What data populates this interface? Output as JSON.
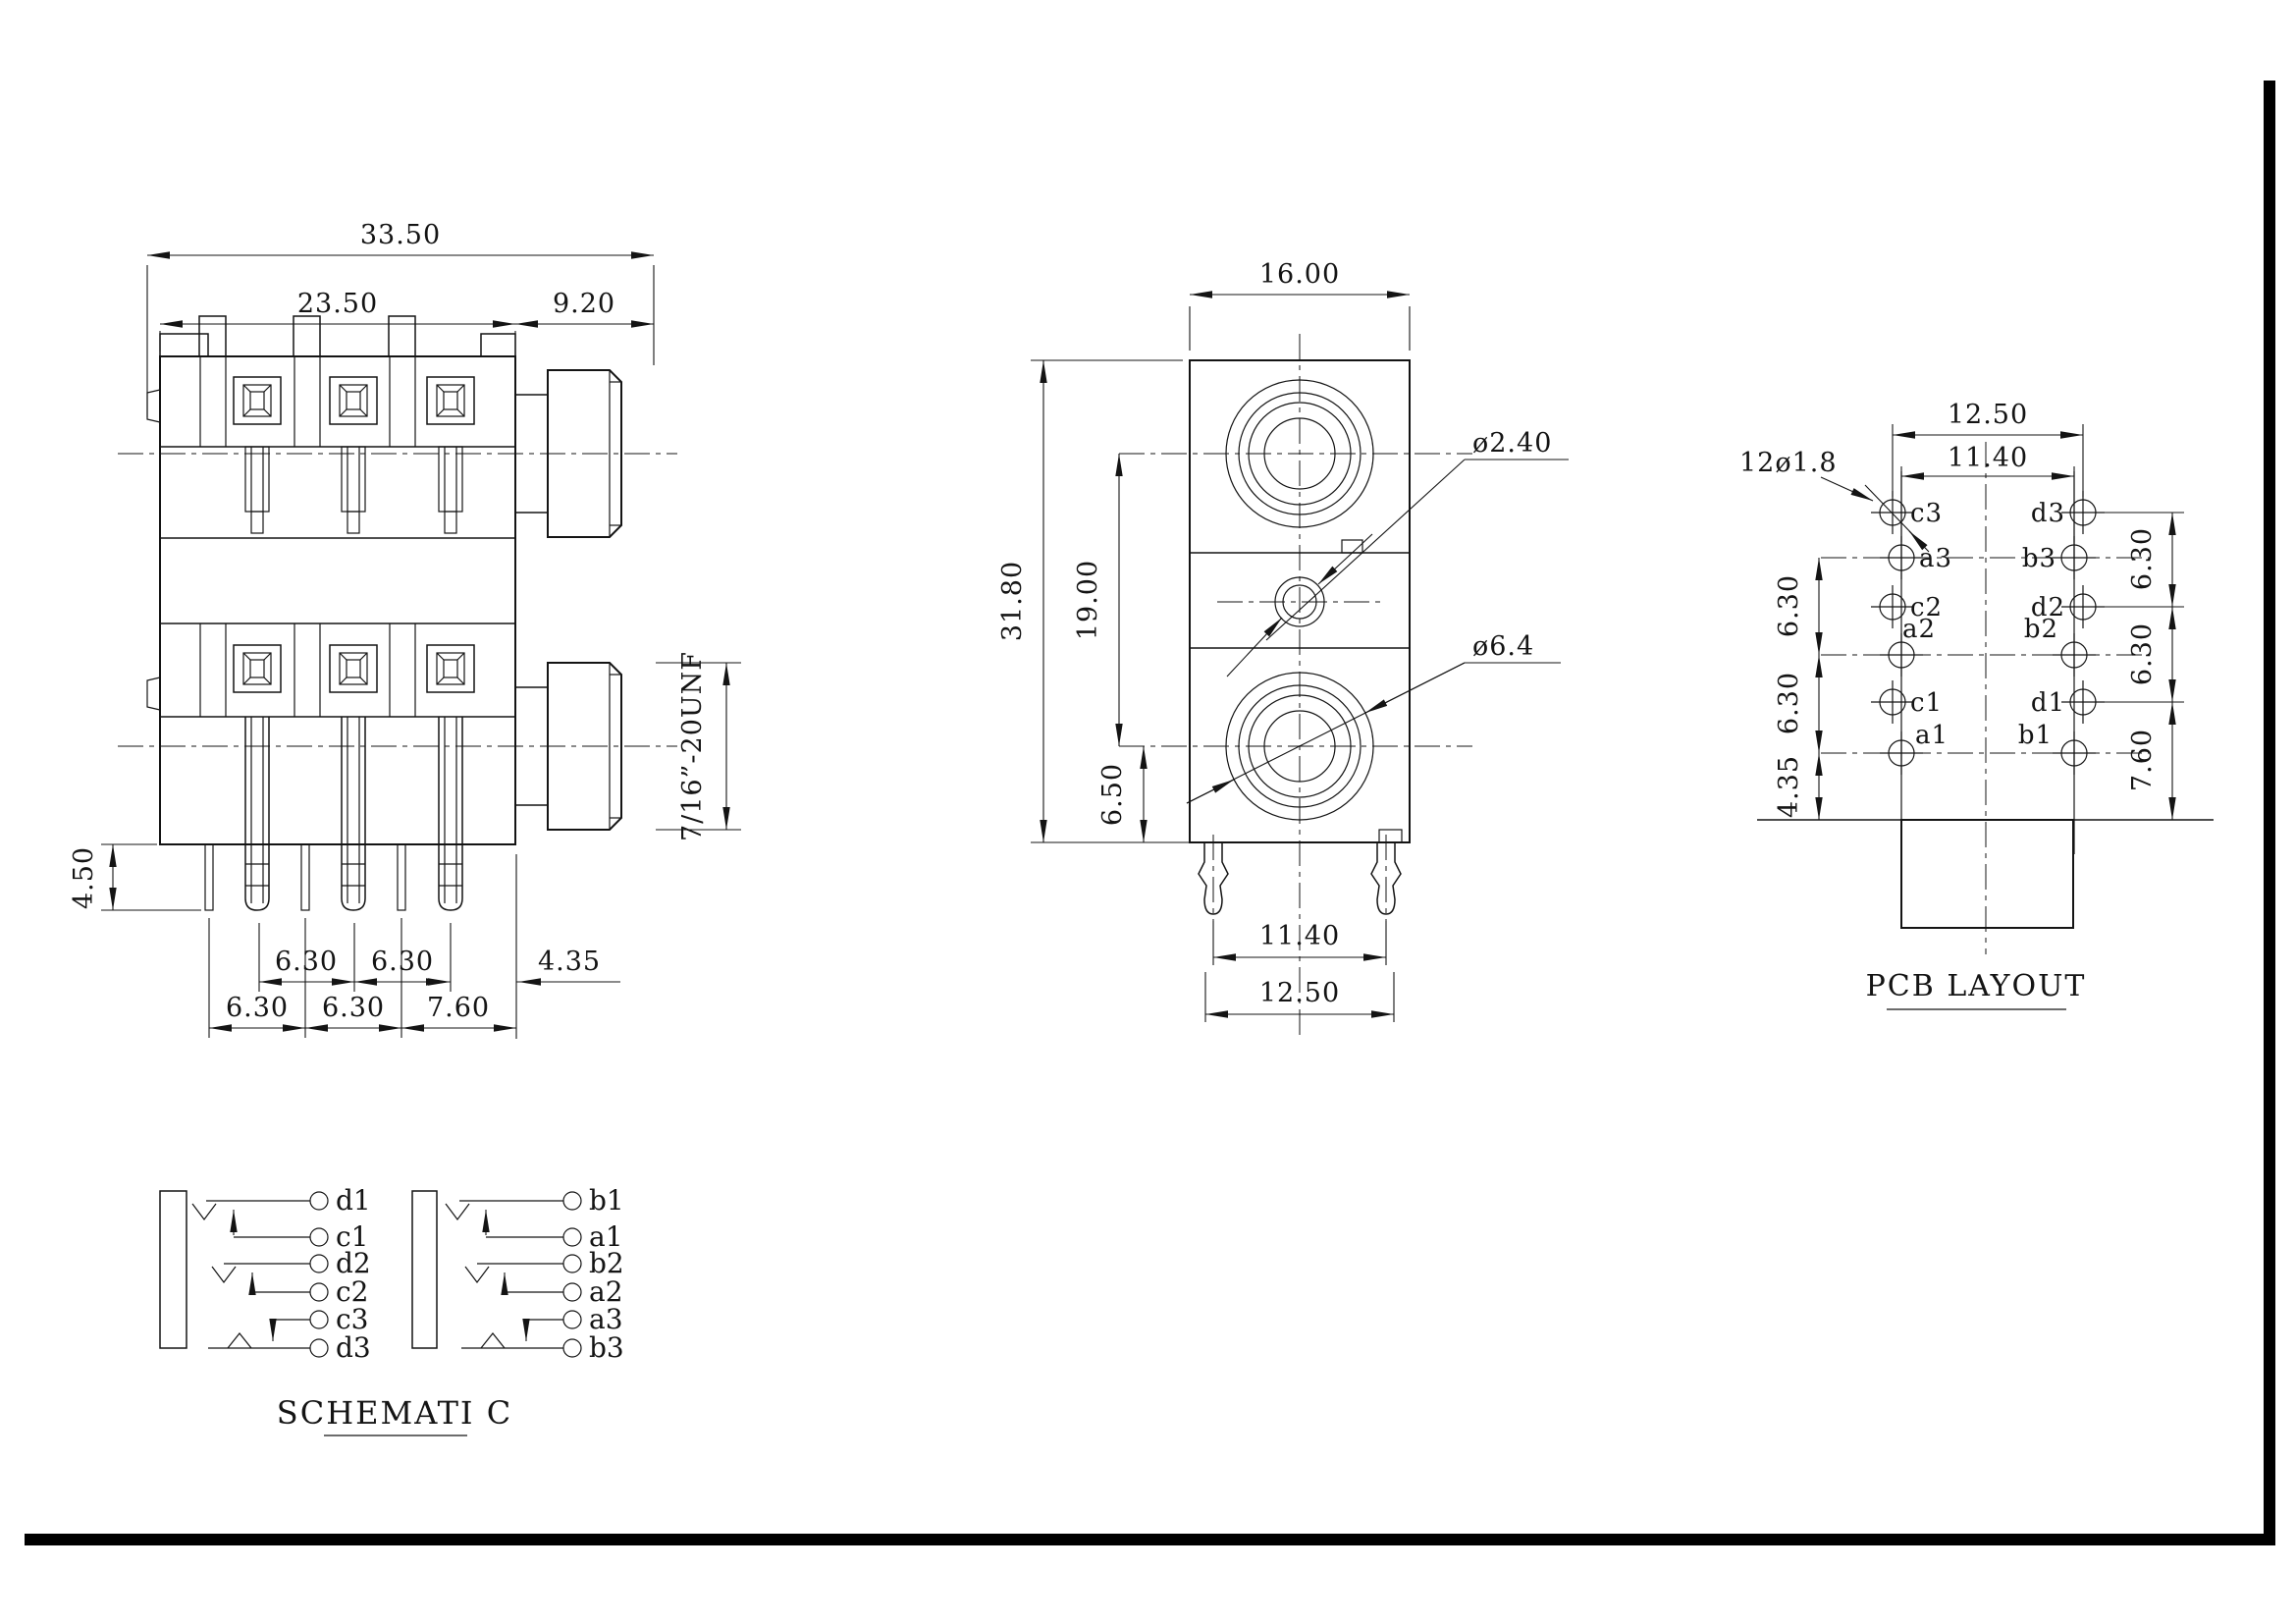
{
  "side_view": {
    "dim_overall": "33.50",
    "dim_body": "23.50",
    "dim_bushing": "9.20",
    "dim_pin_len": "4.50",
    "thread": "7/16”-20UNF",
    "row1_pitch_a": "6.30",
    "row1_pitch_b": "6.30",
    "row1_edge": "4.35",
    "row2_pitch_a": "6.30",
    "row2_pitch_b": "6.30",
    "row2_edge": "7.60"
  },
  "front_view": {
    "dim_width": "16.00",
    "dim_height": "31.80",
    "dim_centers": "19.00",
    "dim_lower": "6.50",
    "hole_small": "ø2.40",
    "hole_large": "ø6.4",
    "dim_leg_span": "11.40",
    "dim_leg_outer": "12.50"
  },
  "pcb_layout": {
    "title": "PCB LAYOUT",
    "dim_outer": "12.50",
    "dim_inner": "11.40",
    "hole_note": "12ø1.8",
    "left_pitch_a": "6.30",
    "left_pitch_b": "6.30",
    "left_edge": "4.35",
    "right_pitch_a": "6.30",
    "right_pitch_b": "6.30",
    "right_edge": "7.60",
    "pads": {
      "c3": "c3",
      "a3": "a3",
      "c2": "c2",
      "a2": "a2",
      "c1": "c1",
      "a1": "a1",
      "d3": "d3",
      "b3": "b3",
      "d2": "d2",
      "b2": "b2",
      "d1": "d1",
      "b1": "b1"
    }
  },
  "schematic": {
    "title": "SCHEMATI C",
    "left_pins": [
      "d1",
      "c1",
      "d2",
      "c2",
      "c3",
      "d3"
    ],
    "right_pins": [
      "b1",
      "a1",
      "b2",
      "a2",
      "a3",
      "b3"
    ]
  }
}
